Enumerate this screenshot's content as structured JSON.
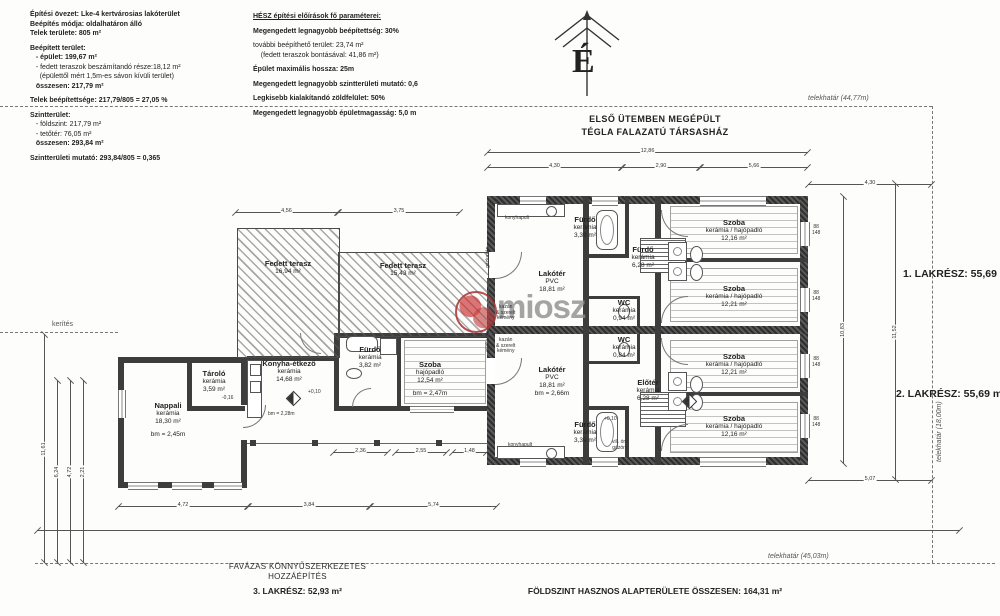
{
  "info_block": {
    "lines": [
      {
        "t": "Építési övezet: Lke-4 kertvárosias lakóterület",
        "b": 1
      },
      {
        "t": "Beépítés módja: oldalhatáron álló",
        "b": 1
      },
      {
        "t": "Telek területe: 805 m²",
        "b": 1
      },
      {
        "t": "",
        "b": 0
      },
      {
        "t": "Beépített terület:",
        "b": 1
      },
      {
        "t": "   - épület: 199,67 m²",
        "b": 1
      },
      {
        "t": "   - fedett teraszok beszámítandó része:18,12 m²",
        "b": 0
      },
      {
        "t": "     (épülettől mért 1,5m-es sávon kívüli terület)",
        "b": 0
      },
      {
        "t": "   összesen: 217,79 m²",
        "b": 1
      },
      {
        "t": "",
        "b": 0
      },
      {
        "t": "Telek beépítettsége: 217,79/805 = 27,05 %",
        "b": 1
      },
      {
        "t": "",
        "b": 0
      },
      {
        "t": "Szintterület:",
        "b": 1
      },
      {
        "t": "   - földszint: 217,79 m²",
        "b": 0
      },
      {
        "t": "   - tetőtér: 76,05 m²",
        "b": 0
      },
      {
        "t": "   összesen: 293,84 m²",
        "b": 1
      },
      {
        "t": "",
        "b": 0
      },
      {
        "t": "Szintterületi mutató: 293,84/805 = 0,365",
        "b": 1
      }
    ]
  },
  "hesz_block": {
    "lines": [
      {
        "t": "HÉSZ építési előírások fő paraméterei:",
        "b": 1,
        "u": 1
      },
      {
        "t": "",
        "b": 0
      },
      {
        "t": "Megengedett legnagyobb beépítettség: 30%",
        "b": 1
      },
      {
        "t": "",
        "b": 0
      },
      {
        "t": "további beépíthető terület: 23,74 m²",
        "b": 0
      },
      {
        "t": "    (fedett teraszok bontásával: 41,86 m²)",
        "b": 0
      },
      {
        "t": "",
        "b": 0
      },
      {
        "t": "Épület maximális hossza: 25m",
        "b": 1
      },
      {
        "t": "",
        "b": 0
      },
      {
        "t": "Megengedett legnagyobb szintterületi mutató: 0,6",
        "b": 1
      },
      {
        "t": "",
        "b": 0
      },
      {
        "t": "Legkisebb kialakítandó zöldfelület: 50%",
        "b": 1
      },
      {
        "t": "",
        "b": 0
      },
      {
        "t": "Megengedett legnagyobb épületmagasság: 5,0 m",
        "b": 1
      }
    ]
  },
  "compass": {
    "letter": "É"
  },
  "site": {
    "top_boundary": "telekhatár (44,77m)",
    "right_boundary": "telekhatár (18,00m)",
    "bottom_boundary": "telekhatár (45,03m)",
    "fence": "kerítés"
  },
  "headings": {
    "phase1_line1": "ELSŐ ÜTEMBEN MEGÉPÜLT",
    "phase1_line2": "TÉGLA FALAZATÚ TÁRSASHÁZ",
    "unit1": "1. LAKRÉSZ: 55,69 m²",
    "unit2": "2. LAKRÉSZ: 55,69 m²",
    "unit3": "3. LAKRÉSZ: 52,93 m²",
    "addition_line1": "FAVÁZAS KÖNNYŰSZERKEZETES",
    "addition_line2": "HOZZÁÉPÍTÉS",
    "total": "FÖLDSZINT HASZNOS ALAPTERÜLETE ÖSSZESEN: 164,31 m²"
  },
  "watermark": {
    "text": "miosz"
  },
  "rooms": [
    {
      "cx": 552,
      "y": 270,
      "lines": [
        "Lakótér",
        "PVC",
        "18,81 m²"
      ]
    },
    {
      "cx": 585,
      "y": 216,
      "lines": [
        "Fürdő",
        "kerámia",
        "3,39 m²"
      ]
    },
    {
      "cx": 643,
      "y": 246,
      "lines": [
        "Fürdő",
        "kerámia",
        "6,28 m²"
      ]
    },
    {
      "cx": 624,
      "y": 299,
      "lines": [
        "WC",
        "kerámia",
        "0,94 m²"
      ]
    },
    {
      "cx": 624,
      "y": 336,
      "lines": [
        "WC",
        "kerámia",
        "0,84 m²"
      ]
    },
    {
      "cx": 648,
      "y": 379,
      "lines": [
        "Előtér",
        "kerámia",
        "6,28 m²"
      ]
    },
    {
      "cx": 585,
      "y": 421,
      "lines": [
        "Fürdő",
        "kerámia",
        "3,39 m²"
      ]
    },
    {
      "cx": 552,
      "y": 366,
      "lines": [
        "Lakótér",
        "PVC",
        "18,81 m²",
        "bm = 2,66m"
      ]
    },
    {
      "cx": 734,
      "y": 219,
      "lines": [
        "Szoba",
        "kerámia / hajópadló",
        "12,16 m²"
      ]
    },
    {
      "cx": 734,
      "y": 285,
      "lines": [
        "Szoba",
        "kerámia / hajópadló",
        "12,21 m²"
      ]
    },
    {
      "cx": 734,
      "y": 353,
      "lines": [
        "Szoba",
        "kerámia / hajópadló",
        "12,21 m²"
      ]
    },
    {
      "cx": 734,
      "y": 415,
      "lines": [
        "Szoba",
        "kerámia / hajópadló",
        "12,16 m²"
      ]
    },
    {
      "cx": 168,
      "y": 402,
      "lines": [
        "Nappali",
        "kerámia",
        "18,30 m²",
        "",
        "bm = 2,45m"
      ]
    },
    {
      "cx": 214,
      "y": 370,
      "lines": [
        "Tároló",
        "kerámia",
        "3,59 m²"
      ]
    },
    {
      "cx": 289,
      "y": 360,
      "lines": [
        "Konyha-étkező",
        "kerámia",
        "14,68 m²"
      ]
    },
    {
      "cx": 370,
      "y": 346,
      "lines": [
        "Fürdő",
        "kerámia",
        "3,82 m²"
      ]
    },
    {
      "cx": 430,
      "y": 361,
      "lines": [
        "Szoba",
        "hajópadló",
        "12,54 m²",
        "",
        "bm = 2,47m"
      ]
    },
    {
      "cx": 288,
      "y": 260,
      "lines": [
        "Fedett terasz",
        "16,94 m²"
      ]
    },
    {
      "cx": 403,
      "y": 262,
      "lines": [
        "Fedett terasz",
        "15,43 m²"
      ]
    }
  ],
  "small_labels": [
    {
      "t": "konyhapult",
      "x": 505,
      "y": 216
    },
    {
      "t": "konyhapult",
      "x": 508,
      "y": 443
    },
    {
      "t": "kazán\n& szerelt\nkémény",
      "x": 496,
      "y": 305
    },
    {
      "t": "kazán\n& szerelt\nkémény",
      "x": 496,
      "y": 338
    },
    {
      "t": "gázkazán",
      "x": 486,
      "y": 268,
      "rot": 1
    },
    {
      "t": "gázkazán",
      "x": 486,
      "y": 352,
      "rot": 1
    },
    {
      "t": "vill. óra\ngázóra",
      "x": 612,
      "y": 440
    },
    {
      "t": "bm = 2,28m",
      "x": 268,
      "y": 412
    },
    {
      "t": "-0,16",
      "x": 222,
      "y": 396
    },
    {
      "t": "+0,10",
      "x": 308,
      "y": 390
    },
    {
      "t": "+0,10",
      "x": 604,
      "y": 417
    },
    {
      "t": "88\n148",
      "x": 812,
      "y": 225
    },
    {
      "t": "88\n148",
      "x": 812,
      "y": 291
    },
    {
      "t": "88\n148",
      "x": 812,
      "y": 357
    },
    {
      "t": "88\n148",
      "x": 812,
      "y": 417
    }
  ],
  "dims": {
    "h": [
      {
        "x": 487,
        "y": 152,
        "w": 321,
        "t": "12,86"
      },
      {
        "x": 487,
        "y": 167,
        "w": 135,
        "t": "4,30"
      },
      {
        "x": 622,
        "y": 167,
        "w": 78,
        "t": "2,90"
      },
      {
        "x": 700,
        "y": 167,
        "w": 108,
        "t": "5,66"
      },
      {
        "x": 235,
        "y": 212,
        "w": 103,
        "t": "4,56"
      },
      {
        "x": 338,
        "y": 212,
        "w": 122,
        "t": "3,75"
      },
      {
        "x": 808,
        "y": 184,
        "w": 124,
        "t": "4,30"
      },
      {
        "x": 808,
        "y": 480,
        "w": 124,
        "t": "5,07"
      },
      {
        "x": 118,
        "y": 506,
        "w": 130,
        "t": "4,72"
      },
      {
        "x": 248,
        "y": 506,
        "w": 122,
        "t": "3,84"
      },
      {
        "x": 370,
        "y": 506,
        "w": 127,
        "t": "5,74"
      },
      {
        "x": 333,
        "y": 452,
        "w": 55,
        "t": "2,36"
      },
      {
        "x": 395,
        "y": 452,
        "w": 52,
        "t": "2,55"
      },
      {
        "x": 452,
        "y": 452,
        "w": 35,
        "t": "1,48"
      },
      {
        "x": 37,
        "y": 530,
        "w": 923,
        "t": ""
      }
    ],
    "v": [
      {
        "x": 843,
        "y": 196,
        "h": 268,
        "t": "10,83"
      },
      {
        "x": 895,
        "y": 183,
        "h": 297,
        "t": "11,52"
      },
      {
        "x": 44,
        "y": 334,
        "h": 229,
        "t": "11,61"
      },
      {
        "x": 57,
        "y": 380,
        "h": 183,
        "t": "6,24"
      },
      {
        "x": 70,
        "y": 380,
        "h": 183,
        "t": "4,72"
      },
      {
        "x": 83,
        "y": 380,
        "h": 183,
        "t": "2,21"
      }
    ]
  }
}
